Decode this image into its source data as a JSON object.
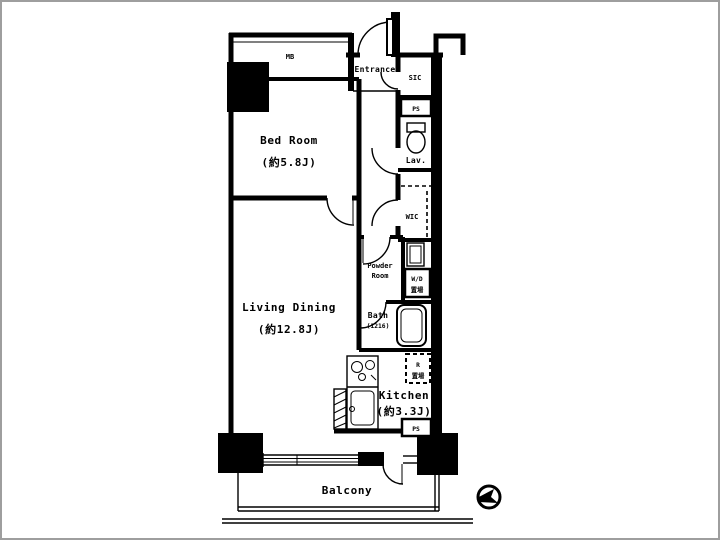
{
  "plan_title": "1LDK apartment floor plan",
  "colors": {
    "wall": "#000000",
    "floor": "#ffffff",
    "frame": "#9e9e9e"
  },
  "rooms": {
    "bed_room": {
      "name": "Bed Room",
      "size": "(約5.8J)"
    },
    "living_dining": {
      "name": "Living Dining",
      "size": "(約12.8J)"
    },
    "kitchen": {
      "name": "Kitchen",
      "size": "(約3.3J)"
    },
    "balcony": {
      "name": "Balcony"
    },
    "entrance": {
      "name": "Entrance"
    },
    "shoe_closet": {
      "name": "SIC"
    },
    "lavatory": {
      "name": "Lav."
    },
    "walk_in_closet": {
      "name": "WIC"
    },
    "powder_room": {
      "name_line1": "Powder",
      "name_line2": "Room"
    },
    "bath": {
      "name": "Bath",
      "size": "(1216)"
    },
    "meter_box": {
      "name": "MB"
    },
    "washer_dryer": {
      "name_line1": "W/D",
      "name_line2": "置場"
    },
    "refrigerator": {
      "name_line1": "R",
      "name_line2": "置場"
    },
    "pipe_space_upper": {
      "name": "PS"
    },
    "pipe_space_lower": {
      "name": "PS"
    }
  }
}
